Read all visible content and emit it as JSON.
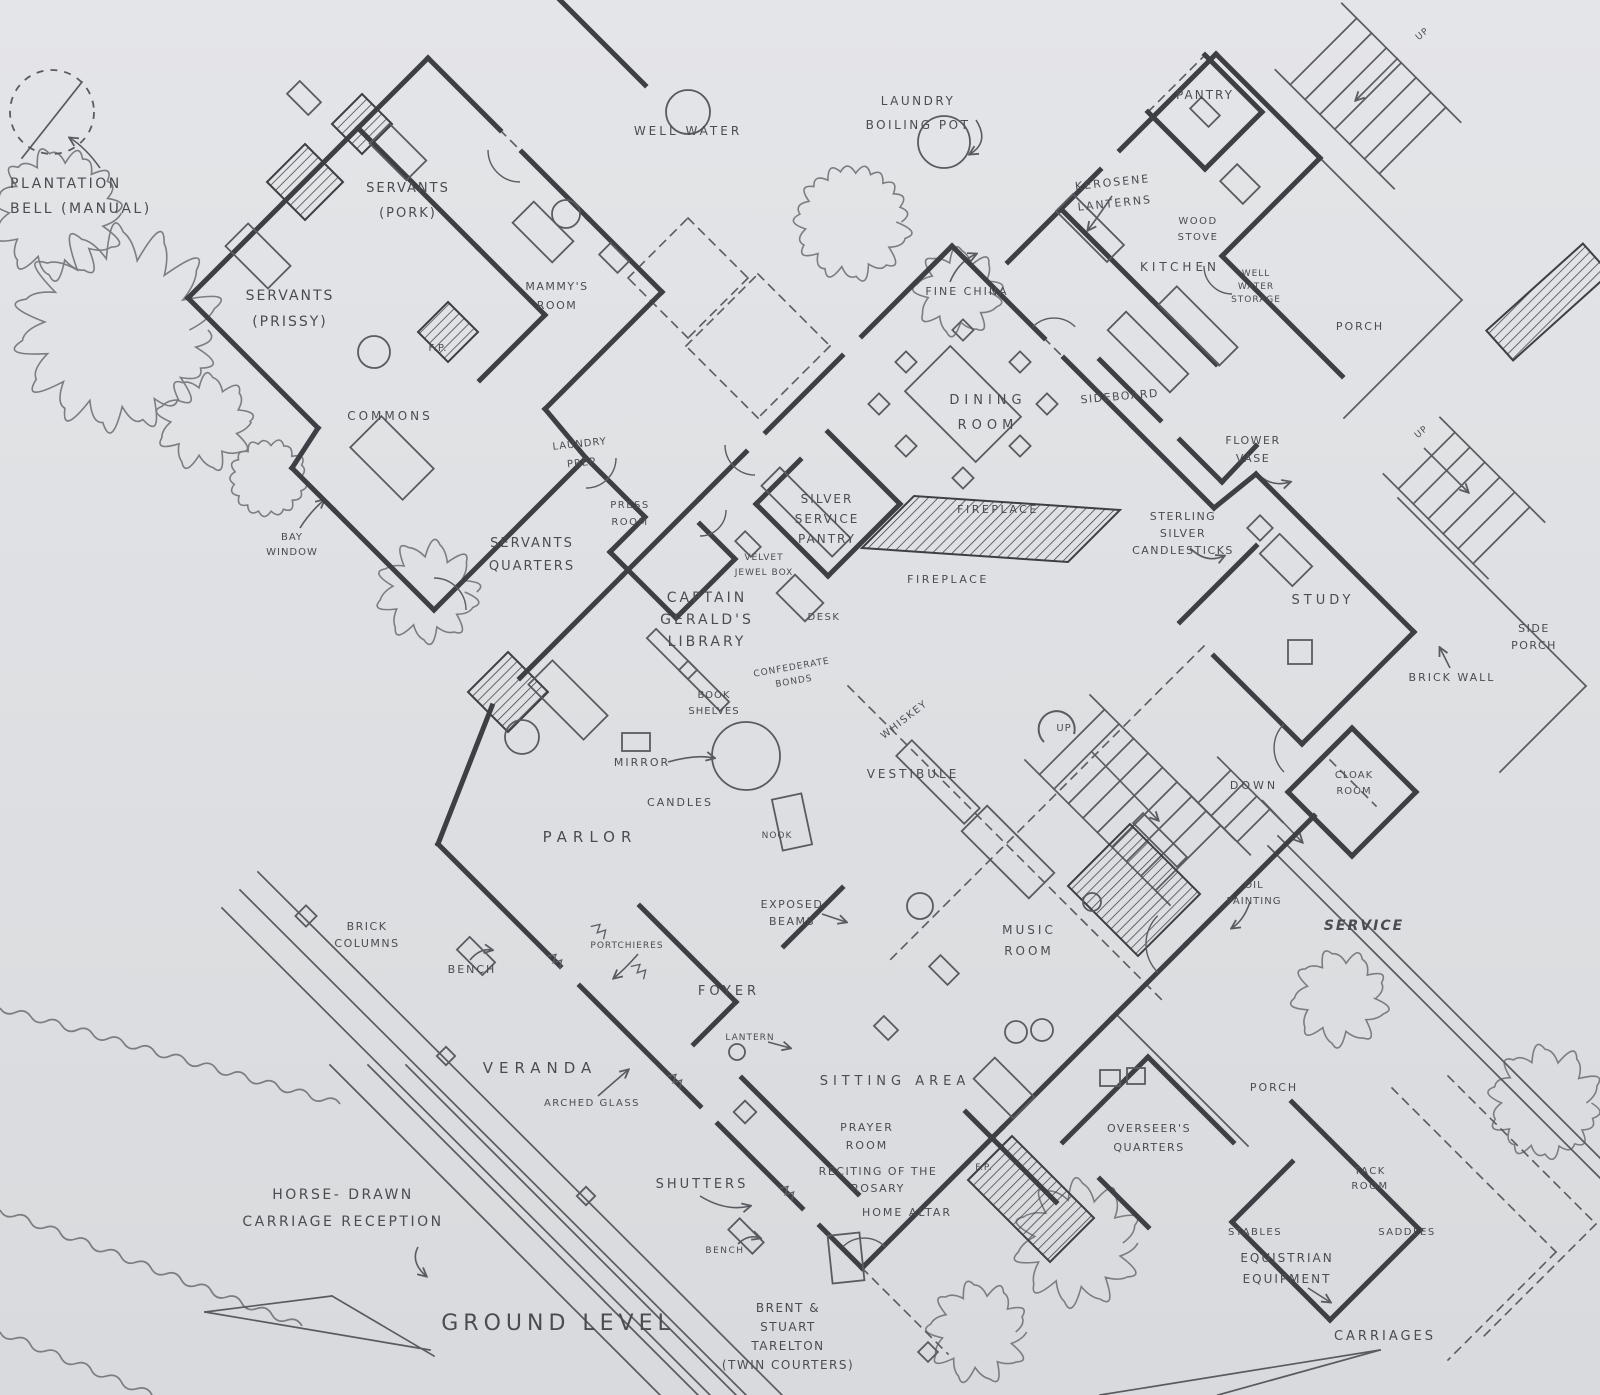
{
  "meta": {
    "drawing_type": "hand-drawn plantation house floor plan",
    "level_label": "GROUND LEVEL"
  },
  "palette": {
    "paper": "#e4e5e8",
    "paper_edge": "#d8dadd",
    "ink_wall": "#3e3f44",
    "ink_thin": "#5a5b60",
    "ink_text": "#4b4c51",
    "ink_tree": "#7b7d81"
  },
  "icons": [
    {
      "name": "plantation-bell-icon",
      "desc": "dashed circle with clapper line"
    },
    {
      "name": "well-water-icon",
      "desc": "small circle"
    },
    {
      "name": "laundry-pot-icon",
      "desc": "small circle"
    },
    {
      "name": "spiral-stair-icon",
      "desc": "grand staircase with curl"
    },
    {
      "name": "fireplace-hatch-icon",
      "desc": "diagonal hatched masonry"
    },
    {
      "name": "tree-icon",
      "desc": "scalloped tree blob"
    }
  ],
  "labels": [
    {
      "name": "plantation-bell-label",
      "lines": [
        "PLANTATION",
        "BELL  (MANUAL)"
      ],
      "x": 10,
      "y": 188,
      "size": 14,
      "lh": 25,
      "ls": 2.5,
      "anchor": "start"
    },
    {
      "name": "servants-pork-label",
      "lines": [
        "SERVANTS",
        "(PORK)"
      ],
      "x": 408,
      "y": 192,
      "size": 13,
      "lh": 25,
      "ls": 2
    },
    {
      "name": "servants-prissy-label",
      "lines": [
        "SERVANTS",
        "(PRISSY)"
      ],
      "x": 290,
      "y": 300,
      "size": 14,
      "lh": 26,
      "ls": 2
    },
    {
      "name": "mammys-room-label",
      "lines": [
        "MAMMY'S",
        "ROOM"
      ],
      "x": 557,
      "y": 290,
      "size": 11,
      "lh": 19,
      "ls": 1.5
    },
    {
      "name": "fp-servants-label",
      "lines": [
        "F.P."
      ],
      "x": 438,
      "y": 351,
      "size": 10,
      "ls": 1
    },
    {
      "name": "well-water-label",
      "lines": [
        "WELL   WATER"
      ],
      "x": 688,
      "y": 135,
      "size": 12,
      "ls": 3
    },
    {
      "name": "laundry-boiling-pot-label",
      "lines": [
        "LAUNDRY",
        "BOILING POT"
      ],
      "x": 918,
      "y": 105,
      "size": 12,
      "lh": 24,
      "ls": 2.5
    },
    {
      "name": "pantry-label",
      "lines": [
        "PANTRY"
      ],
      "x": 1205,
      "y": 99,
      "size": 12,
      "ls": 2
    },
    {
      "name": "kerosene-lanterns-label",
      "lines": [
        "KEROSENE",
        "LANTERNS"
      ],
      "x": 1113,
      "y": 186,
      "size": 11,
      "lh": 21,
      "ls": 2,
      "rot": -6
    },
    {
      "name": "wood-stove-label",
      "lines": [
        "WOOD",
        "STOVE"
      ],
      "x": 1198,
      "y": 224,
      "size": 10,
      "lh": 16,
      "ls": 1.5
    },
    {
      "name": "kitchen-label",
      "lines": [
        "KITCHEN"
      ],
      "x": 1180,
      "y": 271,
      "size": 12,
      "ls": 4
    },
    {
      "name": "well-water-storage-label",
      "lines": [
        "WELL",
        "WATER",
        "STORAGE"
      ],
      "x": 1256,
      "y": 276,
      "size": 9,
      "lh": 13,
      "ls": 1
    },
    {
      "name": "fine-china-label",
      "lines": [
        "FINE  CHINA"
      ],
      "x": 967,
      "y": 295,
      "size": 11,
      "ls": 2
    },
    {
      "name": "porch-top-label",
      "lines": [
        "PORCH"
      ],
      "x": 1360,
      "y": 330,
      "size": 11,
      "ls": 2
    },
    {
      "name": "up-topright-label",
      "lines": [
        "UP"
      ],
      "x": 1424,
      "y": 36,
      "size": 9,
      "ls": 1,
      "rot": -40
    },
    {
      "name": "dining-room-label",
      "lines": [
        "DINING",
        "ROOM"
      ],
      "x": 988,
      "y": 404,
      "size": 13,
      "lh": 25,
      "ls": 5
    },
    {
      "name": "sideboard-label",
      "lines": [
        "SIDEBOARD"
      ],
      "x": 1120,
      "y": 400,
      "size": 11,
      "ls": 1.5,
      "rot": -5
    },
    {
      "name": "flower-vase-label",
      "lines": [
        "FLOWER",
        "VASE"
      ],
      "x": 1253,
      "y": 444,
      "size": 11,
      "lh": 18,
      "ls": 1.5
    },
    {
      "name": "up-right-label",
      "lines": [
        "UP"
      ],
      "x": 1423,
      "y": 434,
      "size": 9,
      "ls": 1,
      "rot": -40
    },
    {
      "name": "commons-label",
      "lines": [
        "COMMONS"
      ],
      "x": 390,
      "y": 420,
      "size": 12,
      "ls": 3
    },
    {
      "name": "bay-window-label",
      "lines": [
        "BAY",
        "WINDOW"
      ],
      "x": 292,
      "y": 540,
      "size": 10,
      "lh": 15,
      "ls": 1
    },
    {
      "name": "laundry-prep-label",
      "lines": [
        "LAUNDRY",
        "PREP"
      ],
      "x": 580,
      "y": 447,
      "size": 10,
      "lh": 19,
      "ls": 1,
      "rot": -6
    },
    {
      "name": "press-room-label",
      "lines": [
        "PRESS",
        "ROOM"
      ],
      "x": 630,
      "y": 508,
      "size": 10,
      "lh": 17,
      "ls": 1.5
    },
    {
      "name": "servants-quarters-label",
      "lines": [
        "SERVANTS",
        "QUARTERS"
      ],
      "x": 532,
      "y": 547,
      "size": 13,
      "lh": 23,
      "ls": 2
    },
    {
      "name": "silver-service-pantry-label",
      "lines": [
        "SILVER",
        "SERVICE",
        "PANTRY"
      ],
      "x": 827,
      "y": 503,
      "size": 12,
      "lh": 20,
      "ls": 2
    },
    {
      "name": "fireplace-upper-label",
      "lines": [
        "FIREPLACE"
      ],
      "x": 998,
      "y": 513,
      "size": 11,
      "ls": 2.5
    },
    {
      "name": "fireplace-lower-label",
      "lines": [
        "FIREPLACE"
      ],
      "x": 948,
      "y": 583,
      "size": 11,
      "ls": 2.5
    },
    {
      "name": "velvet-jewel-box-label",
      "lines": [
        "VELVET",
        "JEWEL BOX"
      ],
      "x": 764,
      "y": 560,
      "size": 9,
      "lh": 15,
      "ls": 1
    },
    {
      "name": "captain-geralds-library-label",
      "lines": [
        "CAPTAIN",
        "GERALD'S",
        "LIBRARY"
      ],
      "x": 707,
      "y": 602,
      "size": 14,
      "lh": 22,
      "ls": 3
    },
    {
      "name": "desk-label",
      "lines": [
        "DESK"
      ],
      "x": 824,
      "y": 620,
      "size": 10,
      "ls": 1.5
    },
    {
      "name": "confederate-bonds-label",
      "lines": [
        "CONFEDERATE",
        "BONDS"
      ],
      "x": 792,
      "y": 670,
      "size": 9,
      "lh": 14,
      "ls": 1,
      "rot": -10
    },
    {
      "name": "book-shelves-label",
      "lines": [
        "BOOK",
        "SHELVES"
      ],
      "x": 714,
      "y": 698,
      "size": 10,
      "lh": 16,
      "ls": 1
    },
    {
      "name": "whiskey-label",
      "lines": [
        "WHISKEY"
      ],
      "x": 906,
      "y": 722,
      "size": 10,
      "ls": 1.5,
      "rot": -38
    },
    {
      "name": "sterling-silver-candlesticks-label",
      "lines": [
        "STERLING",
        "SILVER",
        "CANDLESTICKS"
      ],
      "x": 1183,
      "y": 520,
      "size": 11,
      "lh": 17,
      "ls": 1.5
    },
    {
      "name": "study-label",
      "lines": [
        "STUDY"
      ],
      "x": 1323,
      "y": 604,
      "size": 13,
      "ls": 4
    },
    {
      "name": "side-porch-label",
      "lines": [
        "SIDE",
        "PORCH"
      ],
      "x": 1534,
      "y": 632,
      "size": 11,
      "lh": 17,
      "ls": 1.5
    },
    {
      "name": "brick-wall-label",
      "lines": [
        "BRICK WALL"
      ],
      "x": 1452,
      "y": 681,
      "size": 11,
      "ls": 2
    },
    {
      "name": "up-center-label",
      "lines": [
        "UP"
      ],
      "x": 1064,
      "y": 731,
      "size": 10,
      "ls": 1
    },
    {
      "name": "vestibule-label",
      "lines": [
        "VESTIBULE"
      ],
      "x": 913,
      "y": 778,
      "size": 12,
      "ls": 3
    },
    {
      "name": "down-center-label",
      "lines": [
        "DOWN"
      ],
      "x": 1254,
      "y": 789,
      "size": 11,
      "ls": 3
    },
    {
      "name": "cloak-room-label",
      "lines": [
        "CLOAK",
        "ROOM"
      ],
      "x": 1354,
      "y": 778,
      "size": 10,
      "lh": 16,
      "ls": 1
    },
    {
      "name": "mirror-label",
      "lines": [
        "MIRROR"
      ],
      "x": 642,
      "y": 766,
      "size": 11,
      "ls": 2
    },
    {
      "name": "candles-label",
      "lines": [
        "CANDLES"
      ],
      "x": 680,
      "y": 806,
      "size": 11,
      "ls": 2
    },
    {
      "name": "parlor-label",
      "lines": [
        "PARLOR"
      ],
      "x": 590,
      "y": 842,
      "size": 15,
      "ls": 6
    },
    {
      "name": "nook-label",
      "lines": [
        "NOOK"
      ],
      "x": 777,
      "y": 838,
      "size": 9,
      "ls": 1
    },
    {
      "name": "oil-painting-label",
      "lines": [
        "OIL",
        "PAINTING"
      ],
      "x": 1254,
      "y": 888,
      "size": 10,
      "lh": 16,
      "ls": 1
    },
    {
      "name": "exposed-beams-label",
      "lines": [
        "EXPOSED",
        "BEAMS"
      ],
      "x": 792,
      "y": 908,
      "size": 11,
      "lh": 17,
      "ls": 1.5
    },
    {
      "name": "brick-columns-label",
      "lines": [
        "BRICK",
        "COLUMNS"
      ],
      "x": 367,
      "y": 930,
      "size": 11,
      "lh": 17,
      "ls": 1.5
    },
    {
      "name": "bench-veranda-label",
      "lines": [
        "BENCH"
      ],
      "x": 472,
      "y": 973,
      "size": 11,
      "ls": 2
    },
    {
      "name": "portchieres-label",
      "lines": [
        "PORTCHIERES"
      ],
      "x": 627,
      "y": 948,
      "size": 9,
      "ls": 1
    },
    {
      "name": "foyer-label",
      "lines": [
        "FOYER"
      ],
      "x": 729,
      "y": 995,
      "size": 13,
      "ls": 4
    },
    {
      "name": "music-room-label",
      "lines": [
        "MUSIC",
        "ROOM"
      ],
      "x": 1029,
      "y": 934,
      "size": 12,
      "lh": 21,
      "ls": 3
    },
    {
      "name": "service-label",
      "lines": [
        "SERVICE"
      ],
      "x": 1364,
      "y": 930,
      "size": 14,
      "ls": 2,
      "style": "italic",
      "weight": "bold"
    },
    {
      "name": "veranda-label",
      "lines": [
        "VERANDA"
      ],
      "x": 540,
      "y": 1073,
      "size": 15,
      "ls": 6
    },
    {
      "name": "arched-glass-label",
      "lines": [
        "ARCHED GLASS"
      ],
      "x": 592,
      "y": 1106,
      "size": 10,
      "ls": 1.5
    },
    {
      "name": "lantern-label",
      "lines": [
        "LANTERN"
      ],
      "x": 750,
      "y": 1040,
      "size": 9,
      "ls": 1
    },
    {
      "name": "sitting-area-label",
      "lines": [
        "SITTING  AREA"
      ],
      "x": 895,
      "y": 1085,
      "size": 13,
      "ls": 5
    },
    {
      "name": "prayer-room-label",
      "lines": [
        "PRAYER",
        "ROOM"
      ],
      "x": 867,
      "y": 1131,
      "size": 11,
      "lh": 18,
      "ls": 2
    },
    {
      "name": "shutters-label",
      "lines": [
        "SHUTTERS"
      ],
      "x": 702,
      "y": 1188,
      "size": 13,
      "ls": 3
    },
    {
      "name": "reciting-rosary-label",
      "lines": [
        "RECITING OF THE",
        "ROSARY"
      ],
      "x": 878,
      "y": 1175,
      "size": 11,
      "lh": 17,
      "ls": 1.5
    },
    {
      "name": "home-altar-label",
      "lines": [
        "HOME ALTAR"
      ],
      "x": 907,
      "y": 1216,
      "size": 11,
      "ls": 2
    },
    {
      "name": "fp-prayer-label",
      "lines": [
        "F.P."
      ],
      "x": 984,
      "y": 1170,
      "size": 9,
      "ls": 1
    },
    {
      "name": "bench-south-label",
      "lines": [
        "BENCH"
      ],
      "x": 725,
      "y": 1253,
      "size": 9,
      "ls": 1.5
    },
    {
      "name": "overseers-quarters-label",
      "lines": [
        "OVERSEER'S",
        "QUARTERS"
      ],
      "x": 1149,
      "y": 1132,
      "size": 11,
      "lh": 19,
      "ls": 1.5
    },
    {
      "name": "porch-south-label",
      "lines": [
        "PORCH"
      ],
      "x": 1274,
      "y": 1091,
      "size": 11,
      "ls": 2
    },
    {
      "name": "tack-room-label",
      "lines": [
        "TACK",
        "ROOM"
      ],
      "x": 1370,
      "y": 1174,
      "size": 10,
      "lh": 15,
      "ls": 1.5
    },
    {
      "name": "saddles-label",
      "lines": [
        "SADDLES"
      ],
      "x": 1407,
      "y": 1235,
      "size": 10,
      "ls": 1.5
    },
    {
      "name": "stables-label",
      "lines": [
        "STABLES"
      ],
      "x": 1255,
      "y": 1235,
      "size": 10,
      "ls": 1.5
    },
    {
      "name": "equistrian-equipment-label",
      "lines": [
        "EQUISTRIAN",
        "EQUIPMENT"
      ],
      "x": 1287,
      "y": 1262,
      "size": 12,
      "lh": 21,
      "ls": 2
    },
    {
      "name": "horse-drawn-label",
      "lines": [
        "HORSE- DRAWN",
        "CARRIAGE  RECEPTION"
      ],
      "x": 343,
      "y": 1199,
      "size": 14,
      "lh": 27,
      "ls": 2.5
    },
    {
      "name": "ground-level-label",
      "lines": [
        "GROUND LEVEL"
      ],
      "x": 558,
      "y": 1330,
      "size": 22,
      "ls": 5
    },
    {
      "name": "brent-stuart-label",
      "lines": [
        "BRENT &",
        "STUART",
        "TARELTON",
        "(TWIN COURTERS)"
      ],
      "x": 788,
      "y": 1312,
      "size": 12,
      "lh": 19,
      "ls": 1.5
    },
    {
      "name": "carriages-label",
      "lines": [
        "CARRIAGES"
      ],
      "x": 1385,
      "y": 1340,
      "size": 13,
      "ls": 3
    }
  ]
}
